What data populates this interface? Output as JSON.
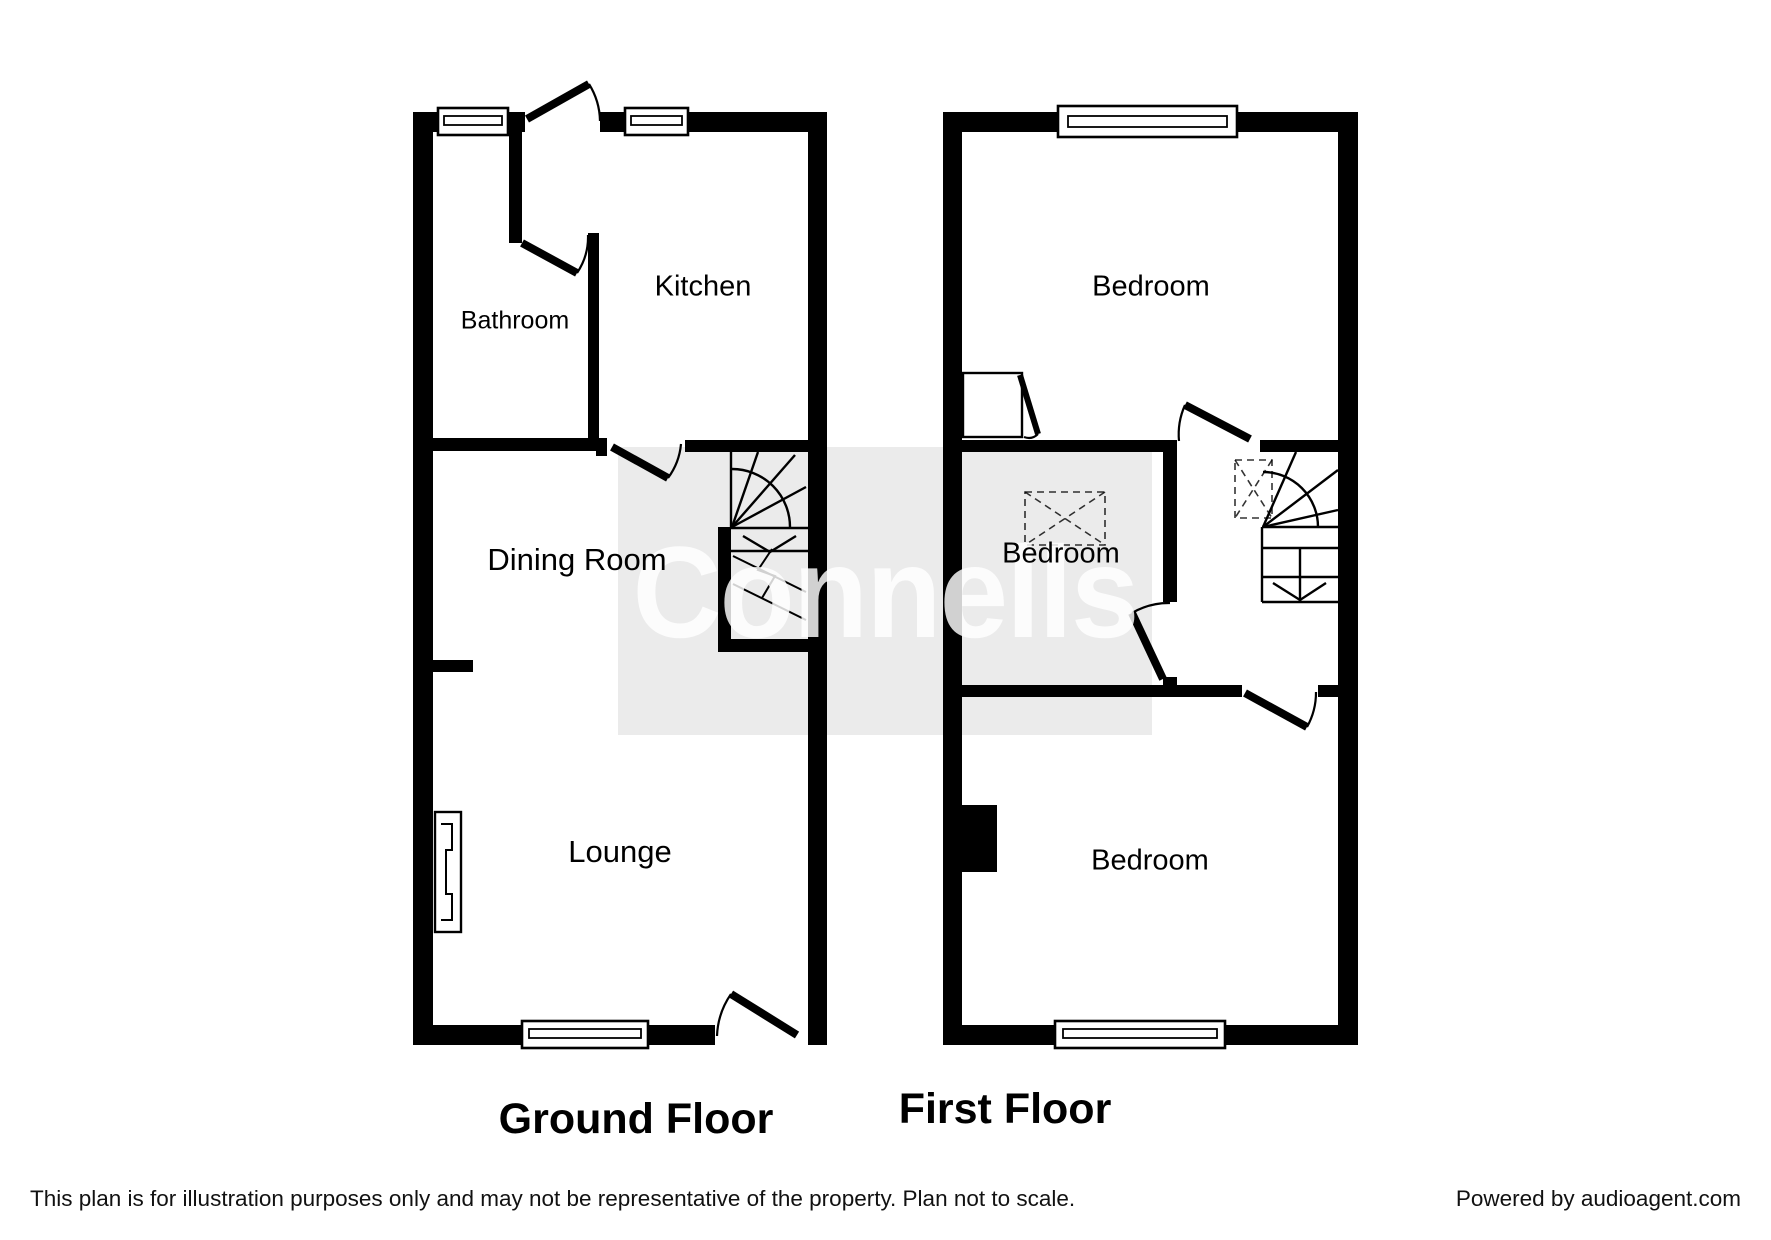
{
  "watermark": {
    "text": "Connells",
    "box_color": "#ebebeb",
    "text_color": "#ffffff"
  },
  "ground_floor": {
    "title": "Ground Floor",
    "rooms": [
      {
        "label": "Bathroom"
      },
      {
        "label": "Kitchen"
      },
      {
        "label": "Dining Room"
      },
      {
        "label": "Lounge"
      }
    ]
  },
  "first_floor": {
    "title": "First Floor",
    "rooms": [
      {
        "label": "Bedroom"
      },
      {
        "label": "Bedroom"
      },
      {
        "label": "Bedroom"
      }
    ]
  },
  "footer": {
    "disclaimer": "This plan is for illustration purposes only and may not be representative of the property. Plan not to scale.",
    "credit": "Powered by audioagent.com"
  },
  "colors": {
    "walls": "#000000",
    "background": "#ffffff"
  }
}
